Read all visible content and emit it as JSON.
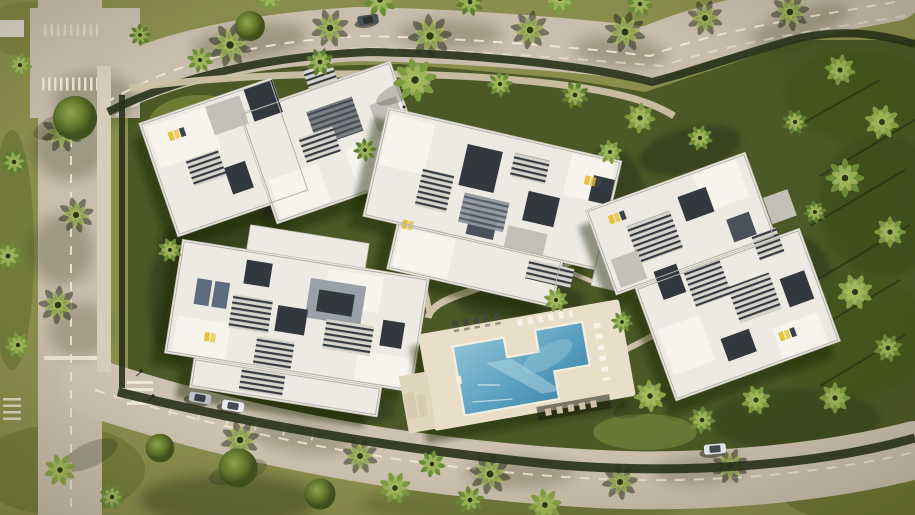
{
  "palette": {
    "grass": "#8a8e4d",
    "grass_shade": "#5c672e",
    "compound_green": "#4c5826",
    "hedge": "#27311a",
    "road": "#c9bead",
    "road_secondary": "#cdc2b0",
    "marking": "#f0ead9",
    "sidewalk": "#d6ccb9",
    "garden_path": "#cdc1a6",
    "building_white": "#edeae3",
    "terrace_white": "#f7f4ed",
    "roof_gray": "#c3c0b8",
    "courtyard_dark": "#33383f",
    "glass_blue": "#5d6c7e",
    "louver_dark": "#363c44",
    "lounger_yellow": "#e6c33c",
    "pool_deck": "#e9dfc9",
    "pool_deep": "#3c83a8",
    "pool_light": "#8ec3d6",
    "palm_green": "#6d8c38",
    "palm_light": "#8aa348",
    "car_white": "#e9ecec",
    "car_silver": "#bcc1c5"
  },
  "scene": {
    "type": "aerial-render-residential-complex",
    "buildings": [
      "northwest-block",
      "central-block",
      "east-block",
      "south-block"
    ],
    "amenities": [
      "cross-shaped-pool",
      "pool-deck",
      "sun-loungers",
      "garden-paths"
    ],
    "roads": [
      "north-avenue",
      "west-street",
      "south-street"
    ],
    "crossings": [
      "west-zebra-crossing",
      "south-zebra-crossing"
    ],
    "vehicles": [
      "dark-car-north-road",
      "silver-car-parked",
      "white-car-parked",
      "white-car-south-road",
      "parked-vehicle-west-edge"
    ]
  }
}
